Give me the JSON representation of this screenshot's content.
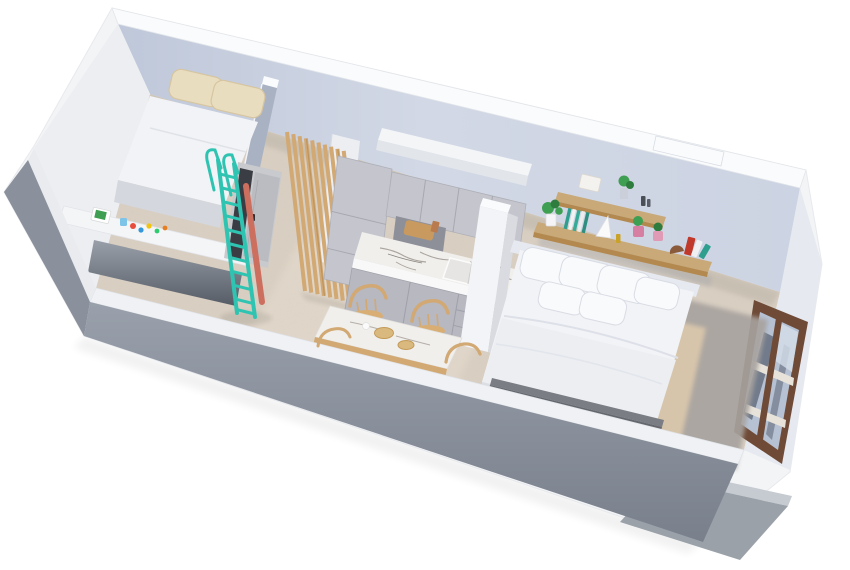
{
  "scene": {
    "type": "3d-floor-plan-render",
    "view": "axonometric cutaway of a long studio apartment, rotated ~13 degrees, on white background",
    "rooms": [
      {
        "id": "loft-bedroom",
        "furniture": [
          "loft-bed",
          "beige-pillows",
          "desk-counter",
          "toys",
          "teal-ship-ladder",
          "bathroom-door"
        ]
      },
      {
        "id": "hallway",
        "furniture": [
          "wood-slat-partition"
        ]
      },
      {
        "id": "kitchen",
        "furniture": [
          "tall-cabinet",
          "upper-cabinets",
          "soffit",
          "marble-counter",
          "sink",
          "black-faucet",
          "cutting-board",
          "base-cabinets",
          "white-divider-pillar"
        ]
      },
      {
        "id": "dining-area",
        "furniture": [
          "marble-top-table",
          "wooden-chairs",
          "wooden-bowls"
        ]
      },
      {
        "id": "living-sleeping-area",
        "furniture": [
          "double-bed",
          "white-pillows",
          "foot-bench",
          "wall-shelves",
          "plants",
          "books",
          "gray-rug",
          "tan-rug"
        ]
      }
    ],
    "exterior": [
      "white-back-wall",
      "gray-concrete-cut-front-wall",
      "brown-framed-window",
      "terrace-slab"
    ],
    "counts": {
      "wood_slats": 10,
      "ladder_rungs": 11,
      "bed_pillows": 6,
      "loft_pillows": 2,
      "shelf_tiers": 2
    }
  },
  "colors": {
    "background": "#ffffff",
    "outer_wall": "#f3f4f6",
    "wall_top": "#fafbfc",
    "wall_face_light": "#eceef2",
    "divider_wall": "#a9b2c2",
    "concrete": "#8a919c",
    "concrete_dark": "#79808b",
    "floor": "#d9cfc2",
    "floor_light": "#e6ddd0",
    "ladder_teal": "#2fc4b2",
    "ladder_strip": "#cd6f5f",
    "wood": "#d2a873",
    "wood_dark": "#b3894f",
    "shelf_wood": "#c8a977",
    "cabinet": "#c5c6cd",
    "cabinet_dark": "#b2b3bb",
    "marble": "#f0efec",
    "marble_vein": "#9b938c",
    "niche": "#8e9099",
    "mattress": "#f2f3f6",
    "pillow_white": "#f9fafc",
    "pillow_beige": "#e9ddbf",
    "door_panel": "#bbbcc1",
    "door_opening": "#3a3d44",
    "pillar": "#f3f4f7",
    "bench": "#65676e",
    "rug_gray": "#a7a29e",
    "rug_tan": "#d7c5ab",
    "window_frame": "#6f4b37",
    "glass": "#b6c2d4",
    "glass_dark": "#39424e",
    "plant": "#3e9e52",
    "plant_dark": "#2e7d3f",
    "pot_pink": "#d77fa3",
    "book_teal": "#2e9e8f",
    "book_red": "#c0392b",
    "faucet": "#17181c"
  }
}
